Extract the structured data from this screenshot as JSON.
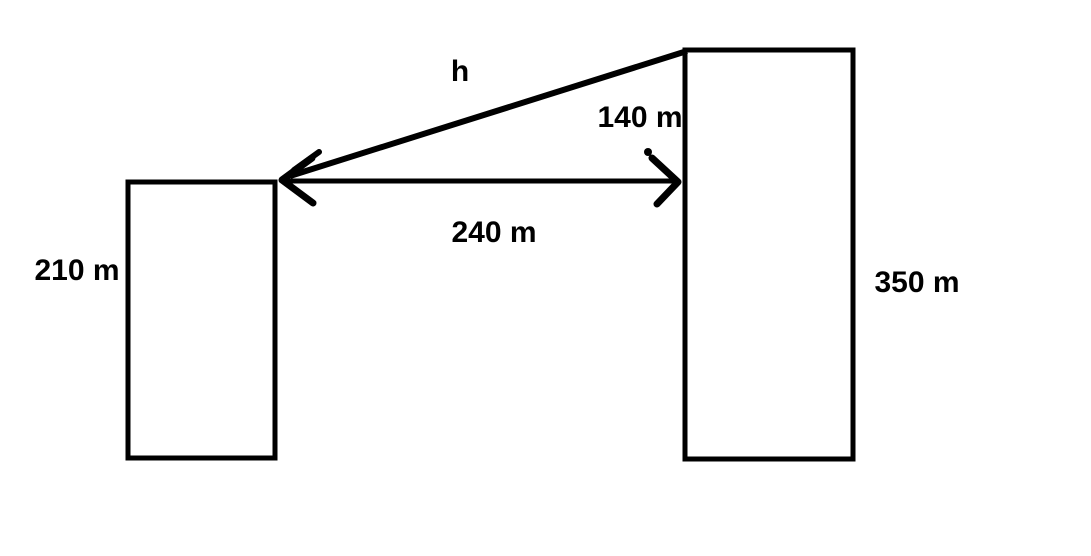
{
  "diagram": {
    "description": "Two buildings geometry problem",
    "colors": {
      "ink": "#000000",
      "background": "#ffffff"
    },
    "labels": {
      "hypotenuse": "h",
      "height_difference": "140 m",
      "horizontal_distance": "240 m",
      "left_building_height": "210 m",
      "right_building_height": "350 m"
    }
  }
}
